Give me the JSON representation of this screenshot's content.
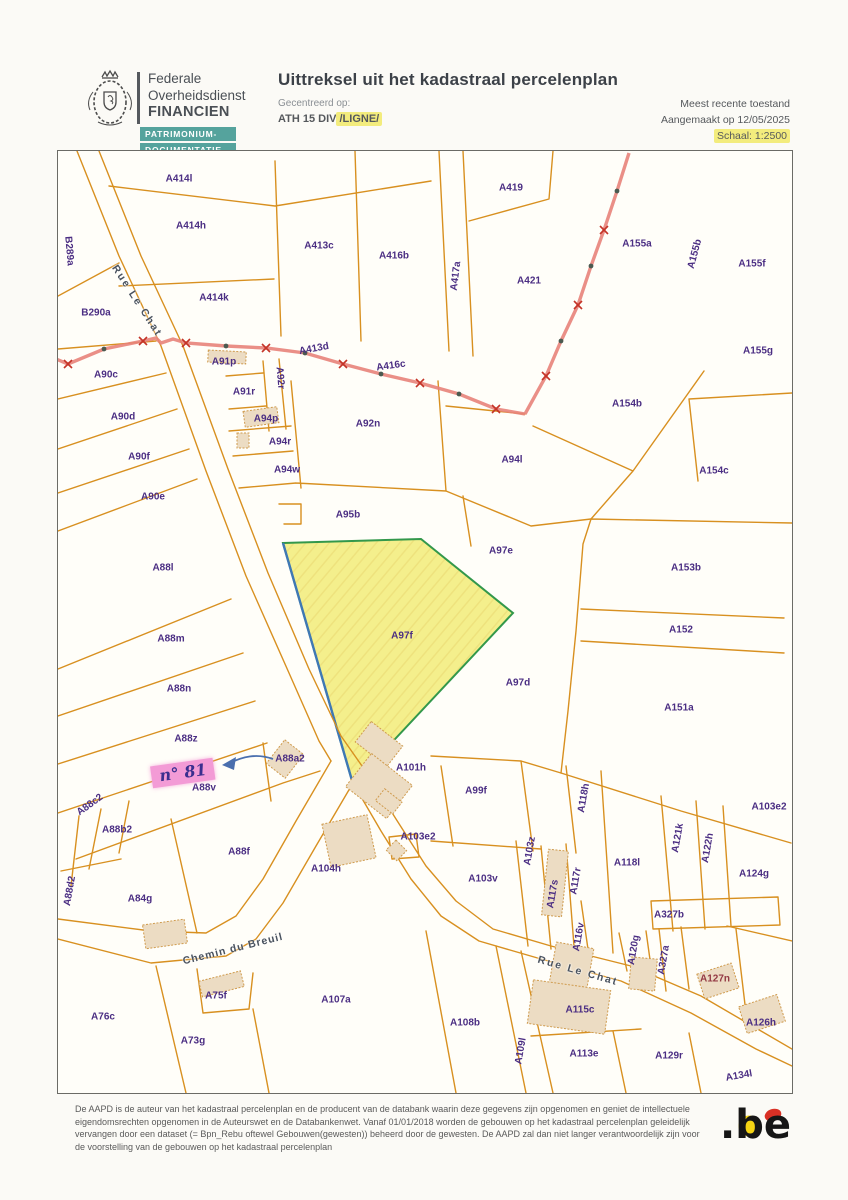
{
  "header": {
    "agency": {
      "line1": "Federale",
      "line2": "Overheidsdienst",
      "line3": "FINANCIEN"
    },
    "badge": {
      "line1": "PATRIMONIUM-",
      "line2": "DOCUMENTATIE"
    },
    "title": "Uittreksel uit het kadastraal percelenplan",
    "centered_label": "Gecentreerd op:",
    "centered_value": "ATH 15 DIV",
    "centered_highlight": "/LIGNE/",
    "status": "Meest recente toestand",
    "created": "Aangemaakt op 12/05/2025",
    "scale": "Schaal: 1:2500"
  },
  "map": {
    "highlighted_parcel": "A97f",
    "annotation": {
      "text": "n° 81",
      "x": 125,
      "y": 622
    },
    "streets": [
      {
        "t": "Rue Le Chat",
        "x": 79,
        "y": 150,
        "rot": 57,
        "ls": 2
      },
      {
        "t": "Chemin du Breuil",
        "x": 175,
        "y": 798,
        "rot": -14,
        "ls": 1
      },
      {
        "t": "Rue Le Chat",
        "x": 520,
        "y": 820,
        "rot": 16,
        "ls": 2
      }
    ],
    "parcels": [
      {
        "t": "A414l",
        "x": 121,
        "y": 28
      },
      {
        "t": "A414h",
        "x": 133,
        "y": 75
      },
      {
        "t": "B289a",
        "x": 11,
        "y": 100,
        "rot": 85
      },
      {
        "t": "B290a",
        "x": 38,
        "y": 162
      },
      {
        "t": "A90c",
        "x": 48,
        "y": 224
      },
      {
        "t": "A91p",
        "x": 166,
        "y": 211
      },
      {
        "t": "A92r",
        "x": 222,
        "y": 227,
        "rot": 85
      },
      {
        "t": "A91r",
        "x": 186,
        "y": 241
      },
      {
        "t": "A413c",
        "x": 261,
        "y": 95
      },
      {
        "t": "A416b",
        "x": 336,
        "y": 105
      },
      {
        "t": "A417a",
        "x": 398,
        "y": 125,
        "rot": -83
      },
      {
        "t": "A419",
        "x": 453,
        "y": 37
      },
      {
        "t": "A421",
        "x": 471,
        "y": 130
      },
      {
        "t": "A155a",
        "x": 579,
        "y": 93
      },
      {
        "t": "A155b",
        "x": 637,
        "y": 103,
        "rot": -75
      },
      {
        "t": "A155f",
        "x": 694,
        "y": 113
      },
      {
        "t": "A155g",
        "x": 700,
        "y": 200
      },
      {
        "t": "A414k",
        "x": 156,
        "y": 147
      },
      {
        "t": "A413d",
        "x": 256,
        "y": 198,
        "rot": -10
      },
      {
        "t": "A416c",
        "x": 333,
        "y": 215,
        "rot": -8
      },
      {
        "t": "A154b",
        "x": 569,
        "y": 253
      },
      {
        "t": "A94p",
        "x": 208,
        "y": 268
      },
      {
        "t": "A92n",
        "x": 310,
        "y": 273
      },
      {
        "t": "A94r",
        "x": 222,
        "y": 291
      },
      {
        "t": "A94w",
        "x": 229,
        "y": 319
      },
      {
        "t": "A90d",
        "x": 65,
        "y": 266
      },
      {
        "t": "A90f",
        "x": 81,
        "y": 306
      },
      {
        "t": "A90e",
        "x": 95,
        "y": 346
      },
      {
        "t": "A94l",
        "x": 454,
        "y": 309
      },
      {
        "t": "A95b",
        "x": 290,
        "y": 364
      },
      {
        "t": "A97e",
        "x": 443,
        "y": 400
      },
      {
        "t": "A154c",
        "x": 656,
        "y": 320
      },
      {
        "t": "A153b",
        "x": 628,
        "y": 417
      },
      {
        "t": "A88l",
        "x": 105,
        "y": 417
      },
      {
        "t": "A97f",
        "x": 344,
        "y": 485
      },
      {
        "t": "A152",
        "x": 623,
        "y": 479
      },
      {
        "t": "A151a",
        "x": 621,
        "y": 557
      },
      {
        "t": "A97d",
        "x": 460,
        "y": 532
      },
      {
        "t": "A88m",
        "x": 113,
        "y": 488
      },
      {
        "t": "A88n",
        "x": 121,
        "y": 538
      },
      {
        "t": "A88z",
        "x": 128,
        "y": 588
      },
      {
        "t": "A88a2",
        "x": 232,
        "y": 608
      },
      {
        "t": "A88v",
        "x": 146,
        "y": 637
      },
      {
        "t": "A88c2",
        "x": 32,
        "y": 654,
        "rot": -36
      },
      {
        "t": "A88b2",
        "x": 59,
        "y": 679
      },
      {
        "t": "A101h",
        "x": 353,
        "y": 617
      },
      {
        "t": "A99f",
        "x": 418,
        "y": 640
      },
      {
        "t": "A118h",
        "x": 526,
        "y": 647,
        "rot": -80
      },
      {
        "t": "A103e2",
        "x": 360,
        "y": 686
      },
      {
        "t": "A103e2",
        "x": 711,
        "y": 656
      },
      {
        "t": "A103z",
        "x": 472,
        "y": 700,
        "rot": -80
      },
      {
        "t": "A103v",
        "x": 425,
        "y": 728
      },
      {
        "t": "A117s",
        "x": 495,
        "y": 743,
        "rot": -80
      },
      {
        "t": "A117r",
        "x": 518,
        "y": 730,
        "rot": -80
      },
      {
        "t": "A116v",
        "x": 521,
        "y": 786,
        "rot": -80
      },
      {
        "t": "A118l",
        "x": 569,
        "y": 712
      },
      {
        "t": "A121k",
        "x": 620,
        "y": 687,
        "rot": -80
      },
      {
        "t": "A122h",
        "x": 650,
        "y": 697,
        "rot": -80
      },
      {
        "t": "A124g",
        "x": 696,
        "y": 723
      },
      {
        "t": "A327b",
        "x": 611,
        "y": 764
      },
      {
        "t": "A120g",
        "x": 576,
        "y": 799,
        "rot": -80
      },
      {
        "t": "A327a",
        "x": 606,
        "y": 809,
        "rot": -80
      },
      {
        "t": "A127n",
        "x": 657,
        "y": 828,
        "c": "#943a44"
      },
      {
        "t": "A126h",
        "x": 703,
        "y": 872
      },
      {
        "t": "A115c",
        "x": 522,
        "y": 859
      },
      {
        "t": "A109l",
        "x": 463,
        "y": 900,
        "rot": -80
      },
      {
        "t": "A113e",
        "x": 526,
        "y": 903
      },
      {
        "t": "A129r",
        "x": 611,
        "y": 905
      },
      {
        "t": "A134l",
        "x": 681,
        "y": 925,
        "rot": -10
      },
      {
        "t": "A108b",
        "x": 407,
        "y": 872
      },
      {
        "t": "A107a",
        "x": 278,
        "y": 849
      },
      {
        "t": "A75f",
        "x": 158,
        "y": 845
      },
      {
        "t": "A76c",
        "x": 45,
        "y": 866
      },
      {
        "t": "A73g",
        "x": 135,
        "y": 890
      },
      {
        "t": "A84g",
        "x": 82,
        "y": 748
      },
      {
        "t": "A88d2",
        "x": 12,
        "y": 740,
        "rot": -80
      },
      {
        "t": "A88f",
        "x": 181,
        "y": 701
      },
      {
        "t": "A104h",
        "x": 268,
        "y": 718
      }
    ]
  },
  "footer": {
    "disclaimer": "De AAPD is de auteur van het kadastraal percelenplan en de producent van de databank waarin deze gegevens zijn opgenomen en geniet de intellectuele eigendomsrechten opgenomen in de Auteurswet en de Databankenwet. Vanaf 01/01/2018 worden de gebouwen op het kadastraal percelenplan geleidelijk vervangen door een dataset (= Bpn_Rebu oftewel Gebouwen(gewesten)) beheerd door de gewesten. De AAPD zal dan niet langer verantwoordelijk zijn voor de voorstelling van de gebouwen op het kadastraal percelenplan",
    "be_logo": ".be"
  },
  "colors": {
    "parcel_line": "#d89020",
    "label_purple": "#4b2e83",
    "highlight_fill": "#f4ef8c",
    "highlight_green": "#33984b",
    "highlight_blue": "#3f78b4",
    "boundary_red": "#e8837a",
    "annotation_pink": "#f39bd6",
    "badge_teal": "#55a39d",
    "highlighter_yellow": "#f3ec7d"
  }
}
